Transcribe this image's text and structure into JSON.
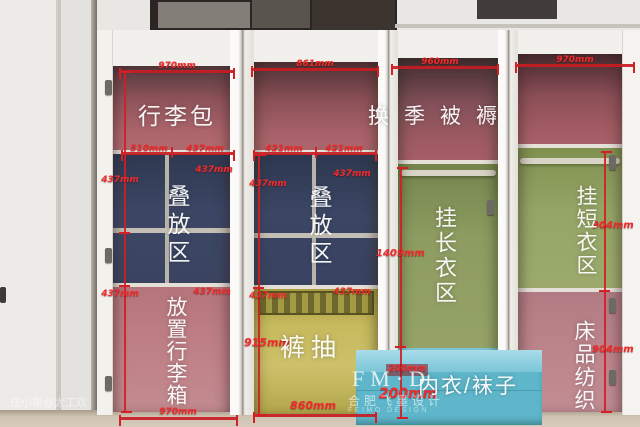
{
  "zones": {
    "luggage_bag": "行李包",
    "fold_zone_1": "叠放区",
    "suitcase": "放置行李箱",
    "fold_zone_2": "叠放区",
    "pants_drawer": "裤抽",
    "seasonal_bedding": "换季被褥",
    "long_hang": "挂长衣区",
    "underwear_socks": "内衣/袜子",
    "short_hang": "挂短衣区",
    "bedding_textile": "床品纺织"
  },
  "dims": {
    "c1_top": "970mm",
    "c2_top": "861mm",
    "c3_top": "960mm",
    "c4_top": "970mm",
    "c1_mid_a": "510mm",
    "c1_mid_b": "437mm",
    "c2_mid_a": "421mm",
    "c2_mid_b": "421mm",
    "c1_cell_tl": "437mm",
    "c1_cell_tr": "437mm",
    "c1_cell_bl": "437mm",
    "c1_cell_br": "437mm",
    "c2_cell_tl": "437mm",
    "c2_cell_tr": "437mm",
    "c2_cell_bl": "437mm",
    "c2_cell_br": "437mm",
    "c1_bottom": "970mm",
    "c2_bottom": "860mm",
    "c2_height": "915mm",
    "c3_height": "1409mm",
    "c3_drawer_small": "200mm",
    "c3_drawer": "200mm",
    "c4_upper": "904mm",
    "c4_lower": "904mm"
  },
  "watermarks": {
    "brand": "FM·D",
    "brand_cn": "合肥飞墨设计",
    "brand_en": "FEIMO DESIGN",
    "corner": "住小帮@太工欢"
  },
  "colors": {
    "dim_red": "#d31f26",
    "zone_red": "#a65f66",
    "zone_blue": "#3a4563",
    "zone_yellow": "#c4b95c",
    "zone_green": "#8b9a5e",
    "zone_teal": "#64b9cd",
    "zone_pink": "#bd7e85"
  }
}
